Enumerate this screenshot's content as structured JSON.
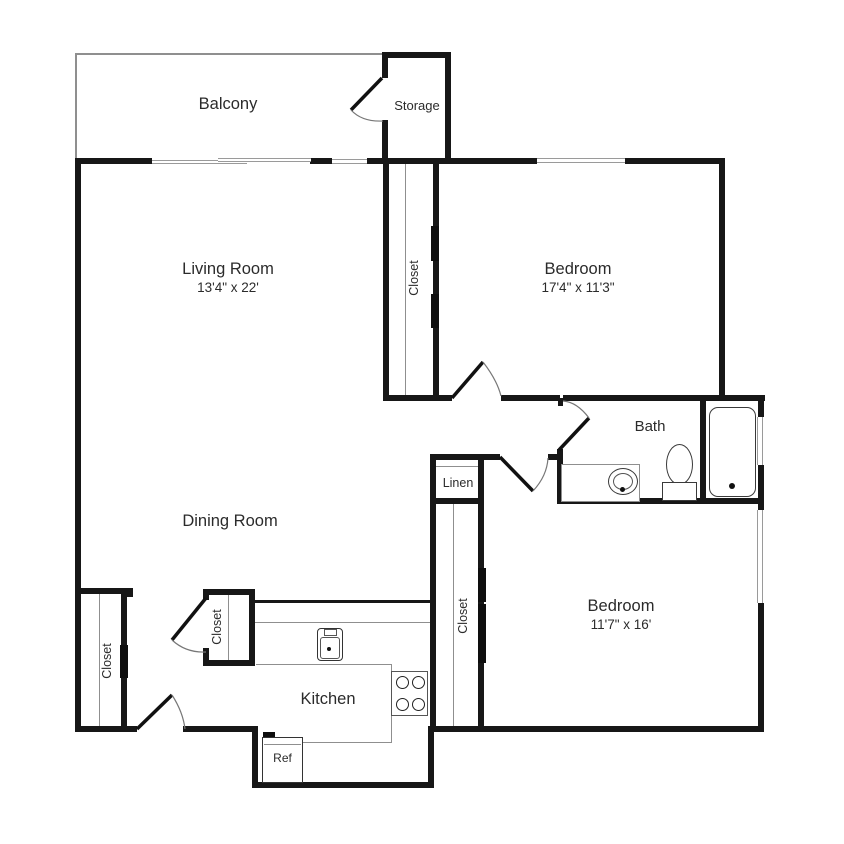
{
  "rooms": {
    "balcony": {
      "label": "Balcony"
    },
    "storage": {
      "label": "Storage"
    },
    "living_room": {
      "label": "Living Room",
      "dimensions": "13'4\" x 22'"
    },
    "bedroom_top": {
      "label": "Bedroom",
      "dimensions": "17'4\" x 11'3\""
    },
    "closet_hall": {
      "label": "Closet"
    },
    "bath": {
      "label": "Bath"
    },
    "linen": {
      "label": "Linen"
    },
    "dining_room": {
      "label": "Dining Room"
    },
    "closet_left": {
      "label": "Closet"
    },
    "closet_dining": {
      "label": "Closet"
    },
    "closet_bedroom": {
      "label": "Closet"
    },
    "kitchen": {
      "label": "Kitchen"
    },
    "refrigerator": {
      "label": "Ref"
    },
    "bedroom_bottom": {
      "label": "Bedroom",
      "dimensions": "11'7\" x 16'"
    }
  },
  "colors": {
    "wall": "#171717",
    "thin_line": "#8f8f8f",
    "text": "#2b2b2b"
  }
}
